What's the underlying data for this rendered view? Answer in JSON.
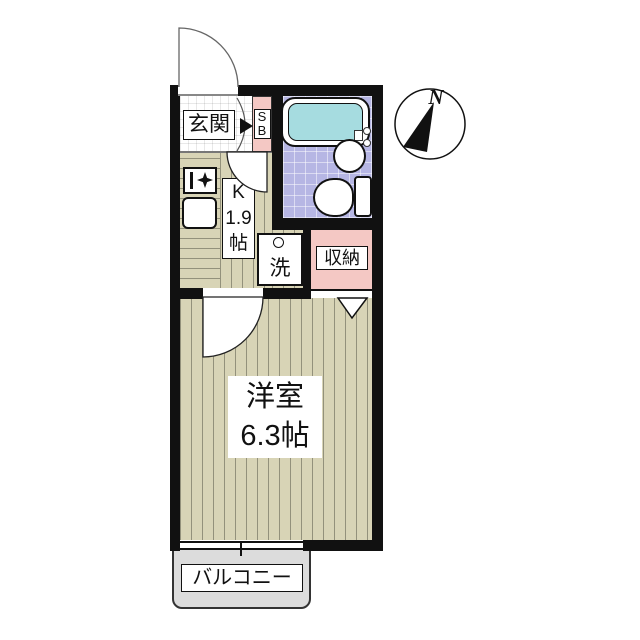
{
  "plan": {
    "compass": {
      "north_label": "N"
    },
    "labels": {
      "genkan": "玄関",
      "shoebox_top": "S",
      "shoebox_bottom": "B",
      "kitchen": "K\n1.9\n帖",
      "washer": "洗",
      "closet": "収納",
      "main_room": "洋室\n6.3帖",
      "balcony": "バルコニー"
    },
    "colors": {
      "wall": "#111111",
      "floor_beige": "#d8d4b6",
      "bath_lavender": "#b6b6e4",
      "tub_cyan": "#a6dce0",
      "closet_pink": "#f4c8c4",
      "balcony_gray": "#dcdcdc"
    }
  }
}
